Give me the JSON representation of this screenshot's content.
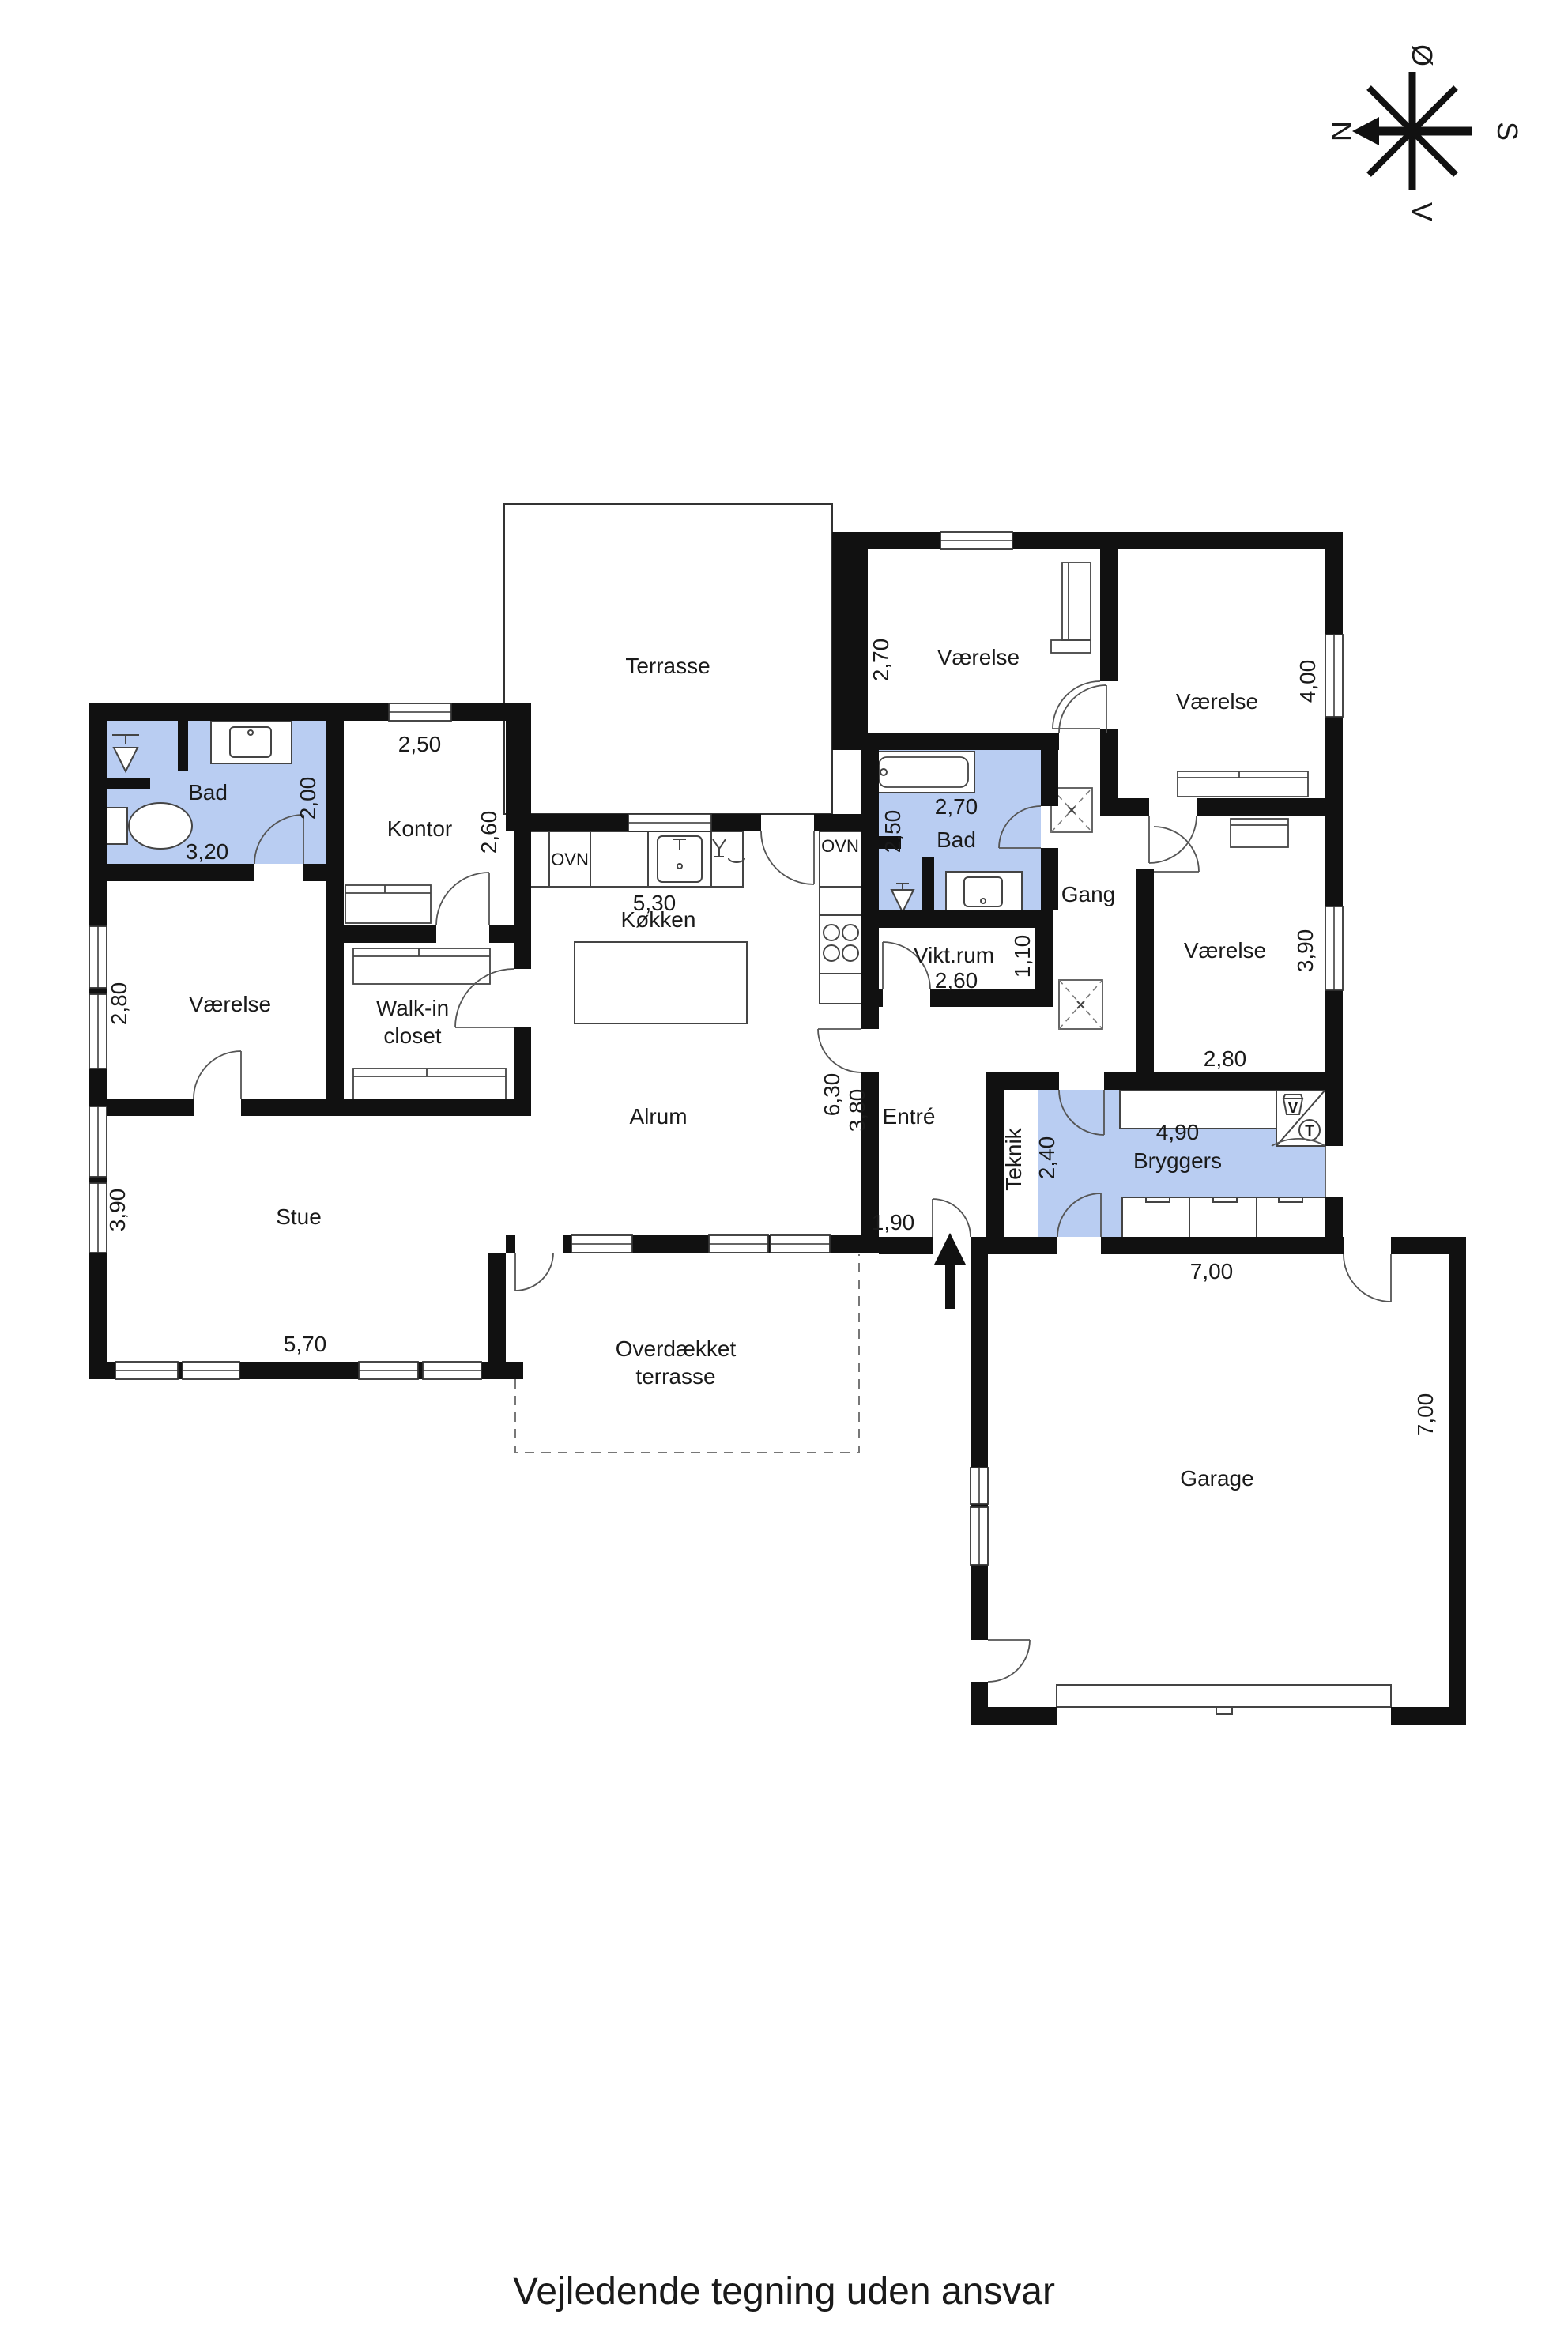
{
  "disclaimer": "Vejledende tegning uden ansvar",
  "compass": {
    "n": "N",
    "e": "Ø",
    "s": "S",
    "v": "V"
  },
  "colors": {
    "wet_room": "#b9cdf2",
    "wall": "#111111"
  },
  "appliances": {
    "oven_left": "OVN",
    "oven_right": "OVN",
    "washer": "V",
    "dryer": "T"
  },
  "rooms": {
    "terrasse": {
      "label": "Terrasse"
    },
    "vaerelse_top": {
      "label": "Værelse",
      "w": "2,70"
    },
    "vaerelse_ne": {
      "label": "Værelse",
      "h": "4,00"
    },
    "vaerelse_e": {
      "label": "Værelse",
      "h": "3,90",
      "w": "2,80"
    },
    "vaerelse_w": {
      "label": "Værelse",
      "h": "2,80"
    },
    "bad_w": {
      "label": "Bad",
      "w": "3,20",
      "h": "2,00"
    },
    "kontor": {
      "label": "Kontor",
      "w": "2,50",
      "h": "2,60"
    },
    "walkin": {
      "label1": "Walk-in",
      "label2": "closet"
    },
    "koekken": {
      "label": "Køkken",
      "w": "5,30"
    },
    "bad_m": {
      "label": "Bad",
      "w": "2,70",
      "h": "2,50"
    },
    "viktrum": {
      "label": "Vikt.rum",
      "w": "2,60",
      "h": "1,10"
    },
    "gang": {
      "label": "Gang"
    },
    "stue": {
      "label": "Stue",
      "w": "5,70",
      "h": "3,90"
    },
    "alrum": {
      "label": "Alrum",
      "h": "6,30"
    },
    "entre": {
      "label": "Entré",
      "h": "3,80",
      "w": "1,90"
    },
    "teknik": {
      "label": "Teknik",
      "h": "2,40"
    },
    "bryggers": {
      "label": "Bryggers",
      "w": "4,90",
      "w_out": "7,00"
    },
    "overdaekket": {
      "label1": "Overdækket",
      "label2": "terrasse"
    },
    "garage": {
      "label": "Garage",
      "w": "7,00",
      "h": "7,00"
    }
  }
}
